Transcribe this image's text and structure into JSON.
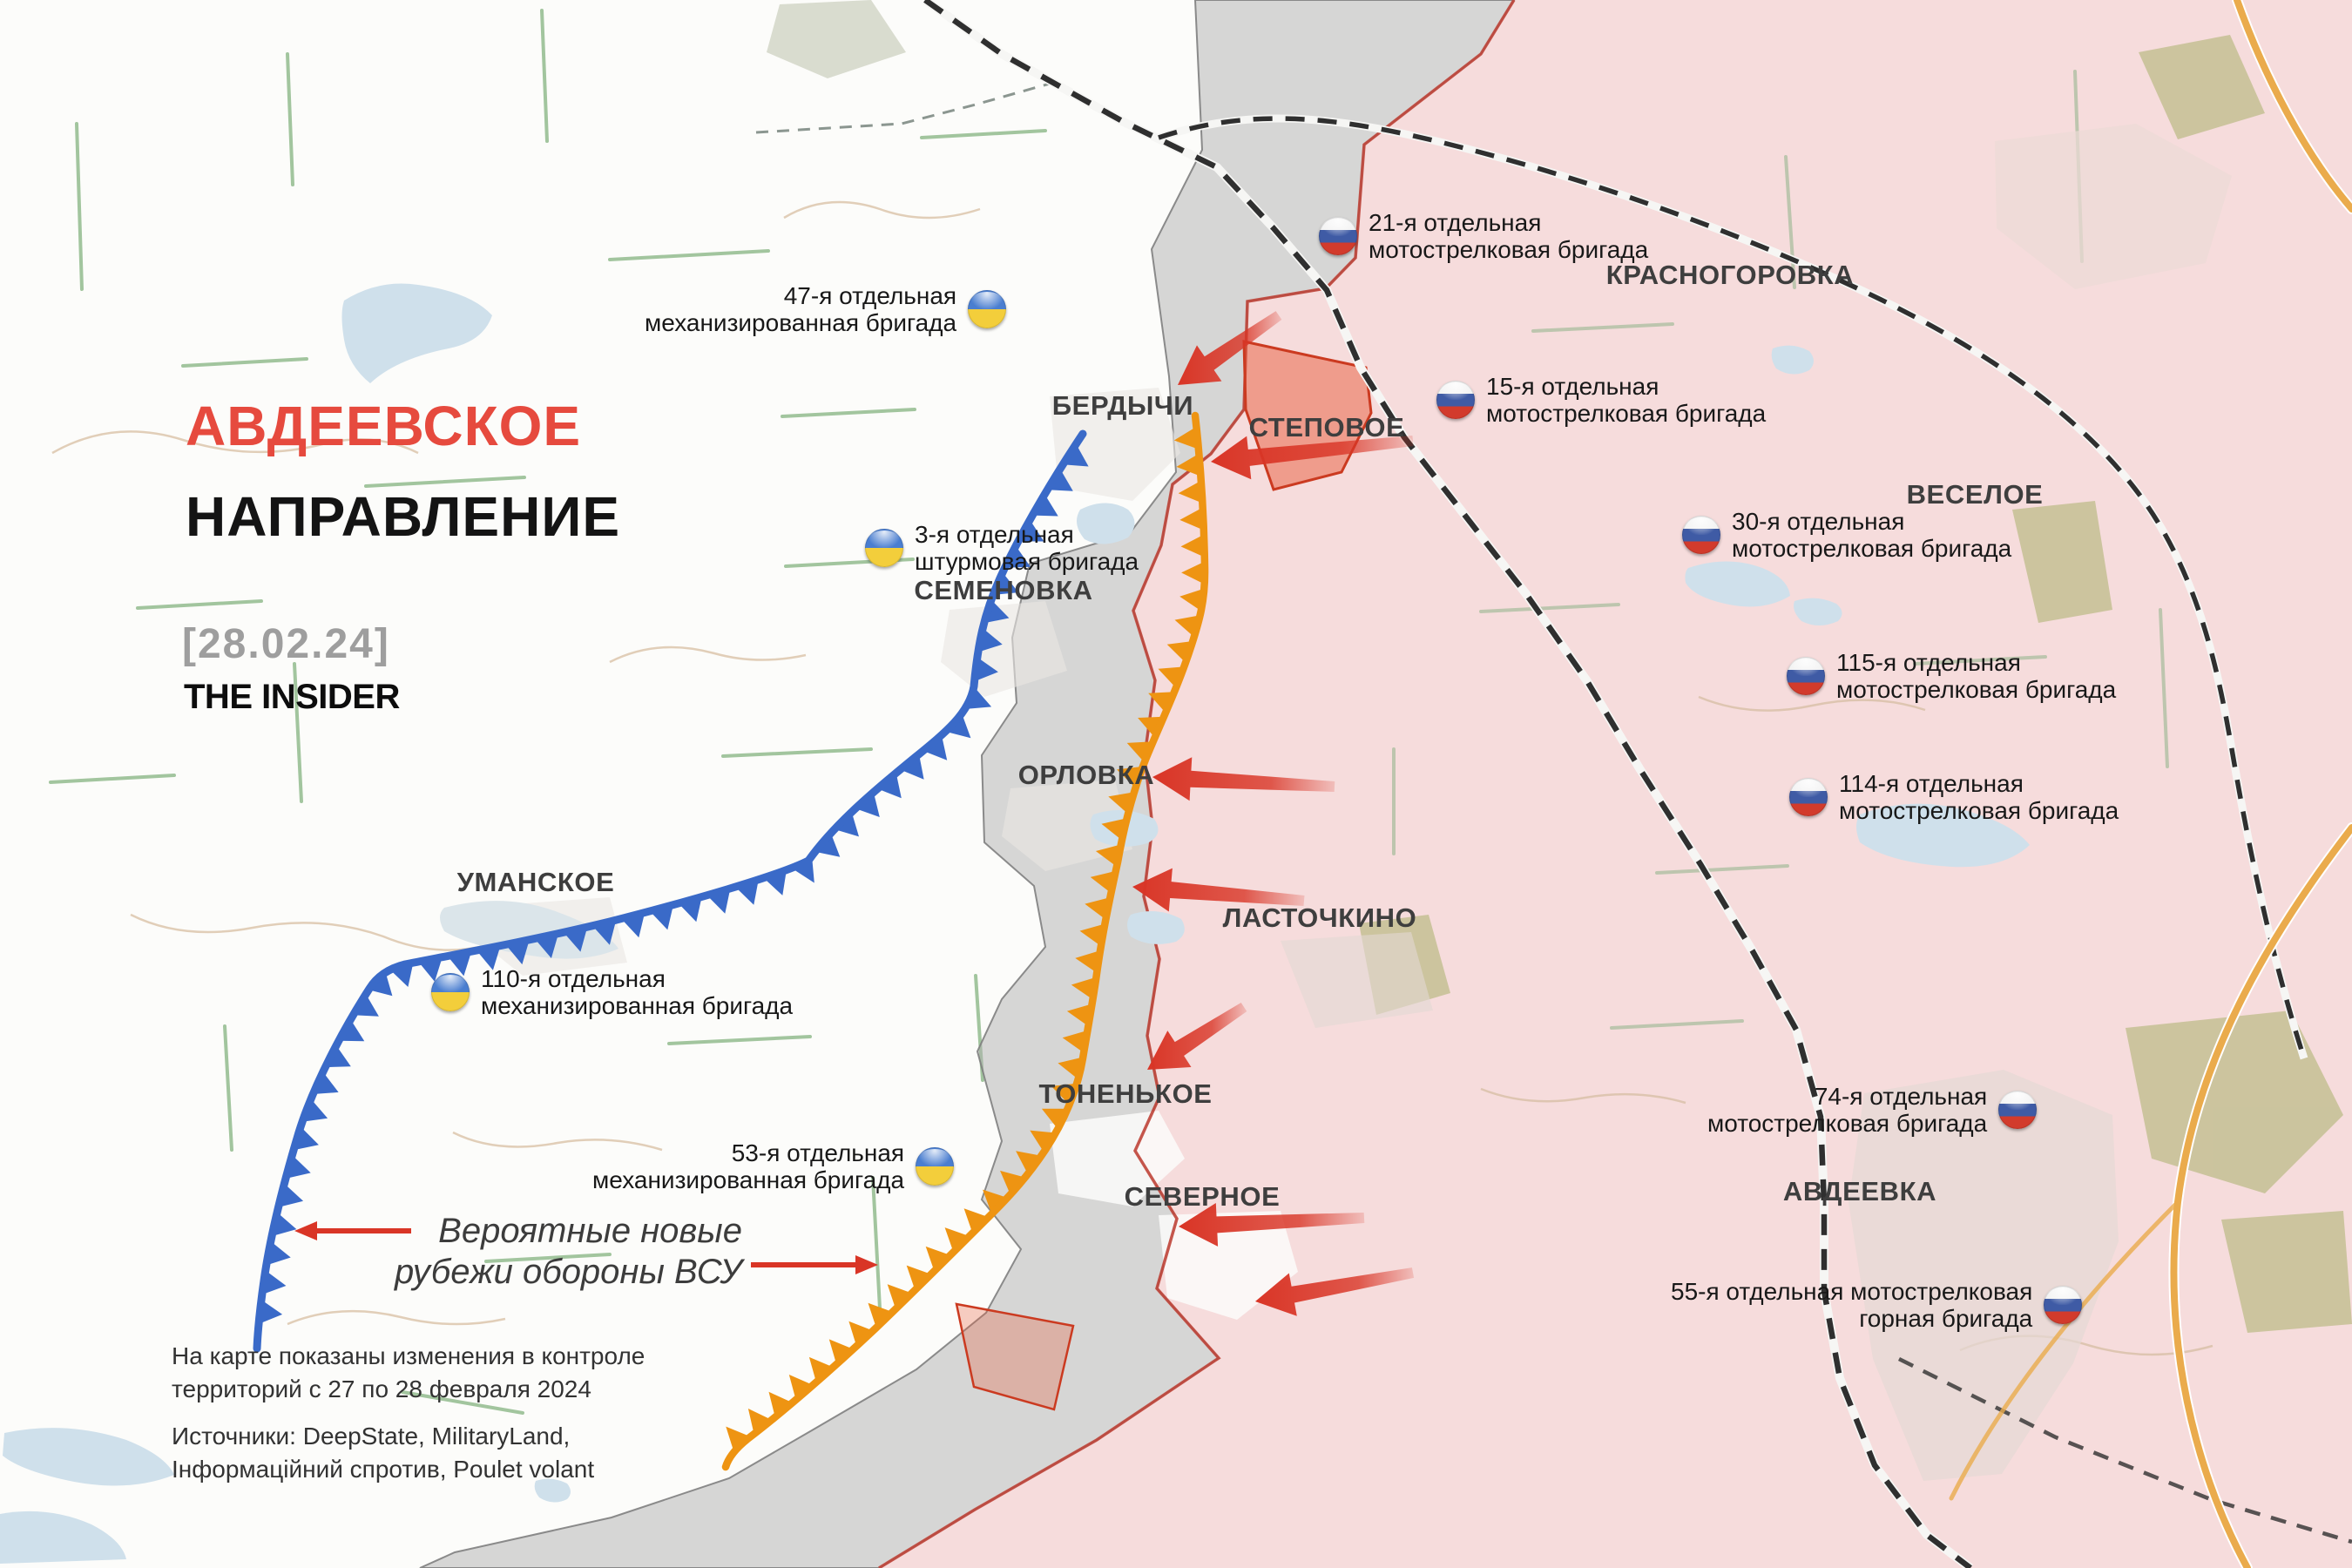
{
  "header": {
    "title_line1": "АВДЕЕВСКОЕ",
    "title_line2": "НАПРАВЛЕНИЕ",
    "date": "[28.02.24]",
    "brand": "THE INSIDER"
  },
  "annotation": {
    "label": "Вероятные новые\nрубежи обороны ВСУ"
  },
  "footer": {
    "note": "На карте показаны изменения в контроле\nтерриторий с 27 по 28 февраля 2024",
    "sources": "Источники: DeepState, MilitaryLand,\nІнформаційний спротив, Poulet volant"
  },
  "settlements": [
    {
      "name": "БЕРДЫЧИ"
    },
    {
      "name": "СТЕПОВОЕ"
    },
    {
      "name": "КРАСНОГОРОВКА"
    },
    {
      "name": "ВЕСЕЛОЕ"
    },
    {
      "name": "СЕМЕНОВКА"
    },
    {
      "name": "ОРЛОВКА"
    },
    {
      "name": "УМАНСКОЕ"
    },
    {
      "name": "ЛАСТОЧКИНО"
    },
    {
      "name": "ТОНЕНЬКОЕ"
    },
    {
      "name": "СЕВЕРНОЕ"
    },
    {
      "name": "АВДЕЕВКА"
    }
  ],
  "brigades": {
    "ukrainian": [
      {
        "name": "47-я отдельная\nмеханизированная бригада"
      },
      {
        "name": "3-я отдельная\nштурмовая бригада"
      },
      {
        "name": "110-я отдельная\nмеханизированная бригада"
      },
      {
        "name": "53-я отдельная\nмеханизированная бригада"
      }
    ],
    "russian": [
      {
        "name": "21-я отдельная\nмотострелковая бригада"
      },
      {
        "name": "15-я отдельная\nмотострелковая бригада"
      },
      {
        "name": "30-я отдельная\nмотострелковая бригада"
      },
      {
        "name": "115-я отдельная\nмотострелковая бригада"
      },
      {
        "name": "114-я отдельная\nмотострелковая бригада"
      },
      {
        "name": "74-я отдельная\nмотострелковая бригада"
      },
      {
        "name": "55-я отдельная мотострелковая\nгорная бригада"
      }
    ]
  },
  "colors": {
    "title_accent": "#e64a3e",
    "ukraine_defense_line": "#3a6ac8",
    "probable_new_line": "#ee9412",
    "attack_arrow": "#d93526",
    "russian_controlled_fill": "#f6dcdc",
    "advance_area": "#e85c3c",
    "contested_zone": "#b9b9b9",
    "ua_flag_blue": "#4a7ed0",
    "ua_flag_yellow": "#f3ce3b",
    "ru_flag_blue": "#3f5ba5",
    "ru_flag_red": "#d23b2c"
  }
}
